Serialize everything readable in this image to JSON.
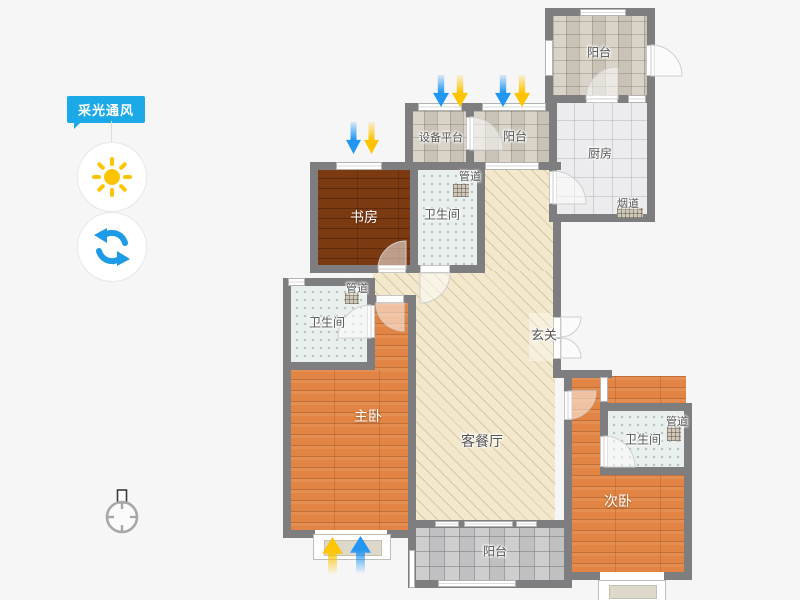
{
  "panel": {
    "title": "采光通风"
  },
  "rooms": {
    "balcony_top_right": "阳台",
    "equipment_platform": "设备平台",
    "balcony_top": "阳台",
    "kitchen": "厨房",
    "flue": "烟道",
    "duct_top": "管道",
    "study": "书房",
    "bathroom_top": "卫生间",
    "duct_mid": "管道",
    "bathroom_left": "卫生间",
    "entry": "玄关",
    "master_bedroom": "主卧",
    "living_dining": "客餐厅",
    "duct_right": "管道",
    "bathroom_right": "卫生间",
    "second_bedroom": "次卧",
    "balcony_bottom": "阳台"
  },
  "colors": {
    "accent_blue": "#1ca9e8",
    "sun_yellow": "#fec400",
    "arrow_blue": "#2196f3",
    "arrow_yellow": "#fec400",
    "wall_gray": "#7e7e80"
  }
}
